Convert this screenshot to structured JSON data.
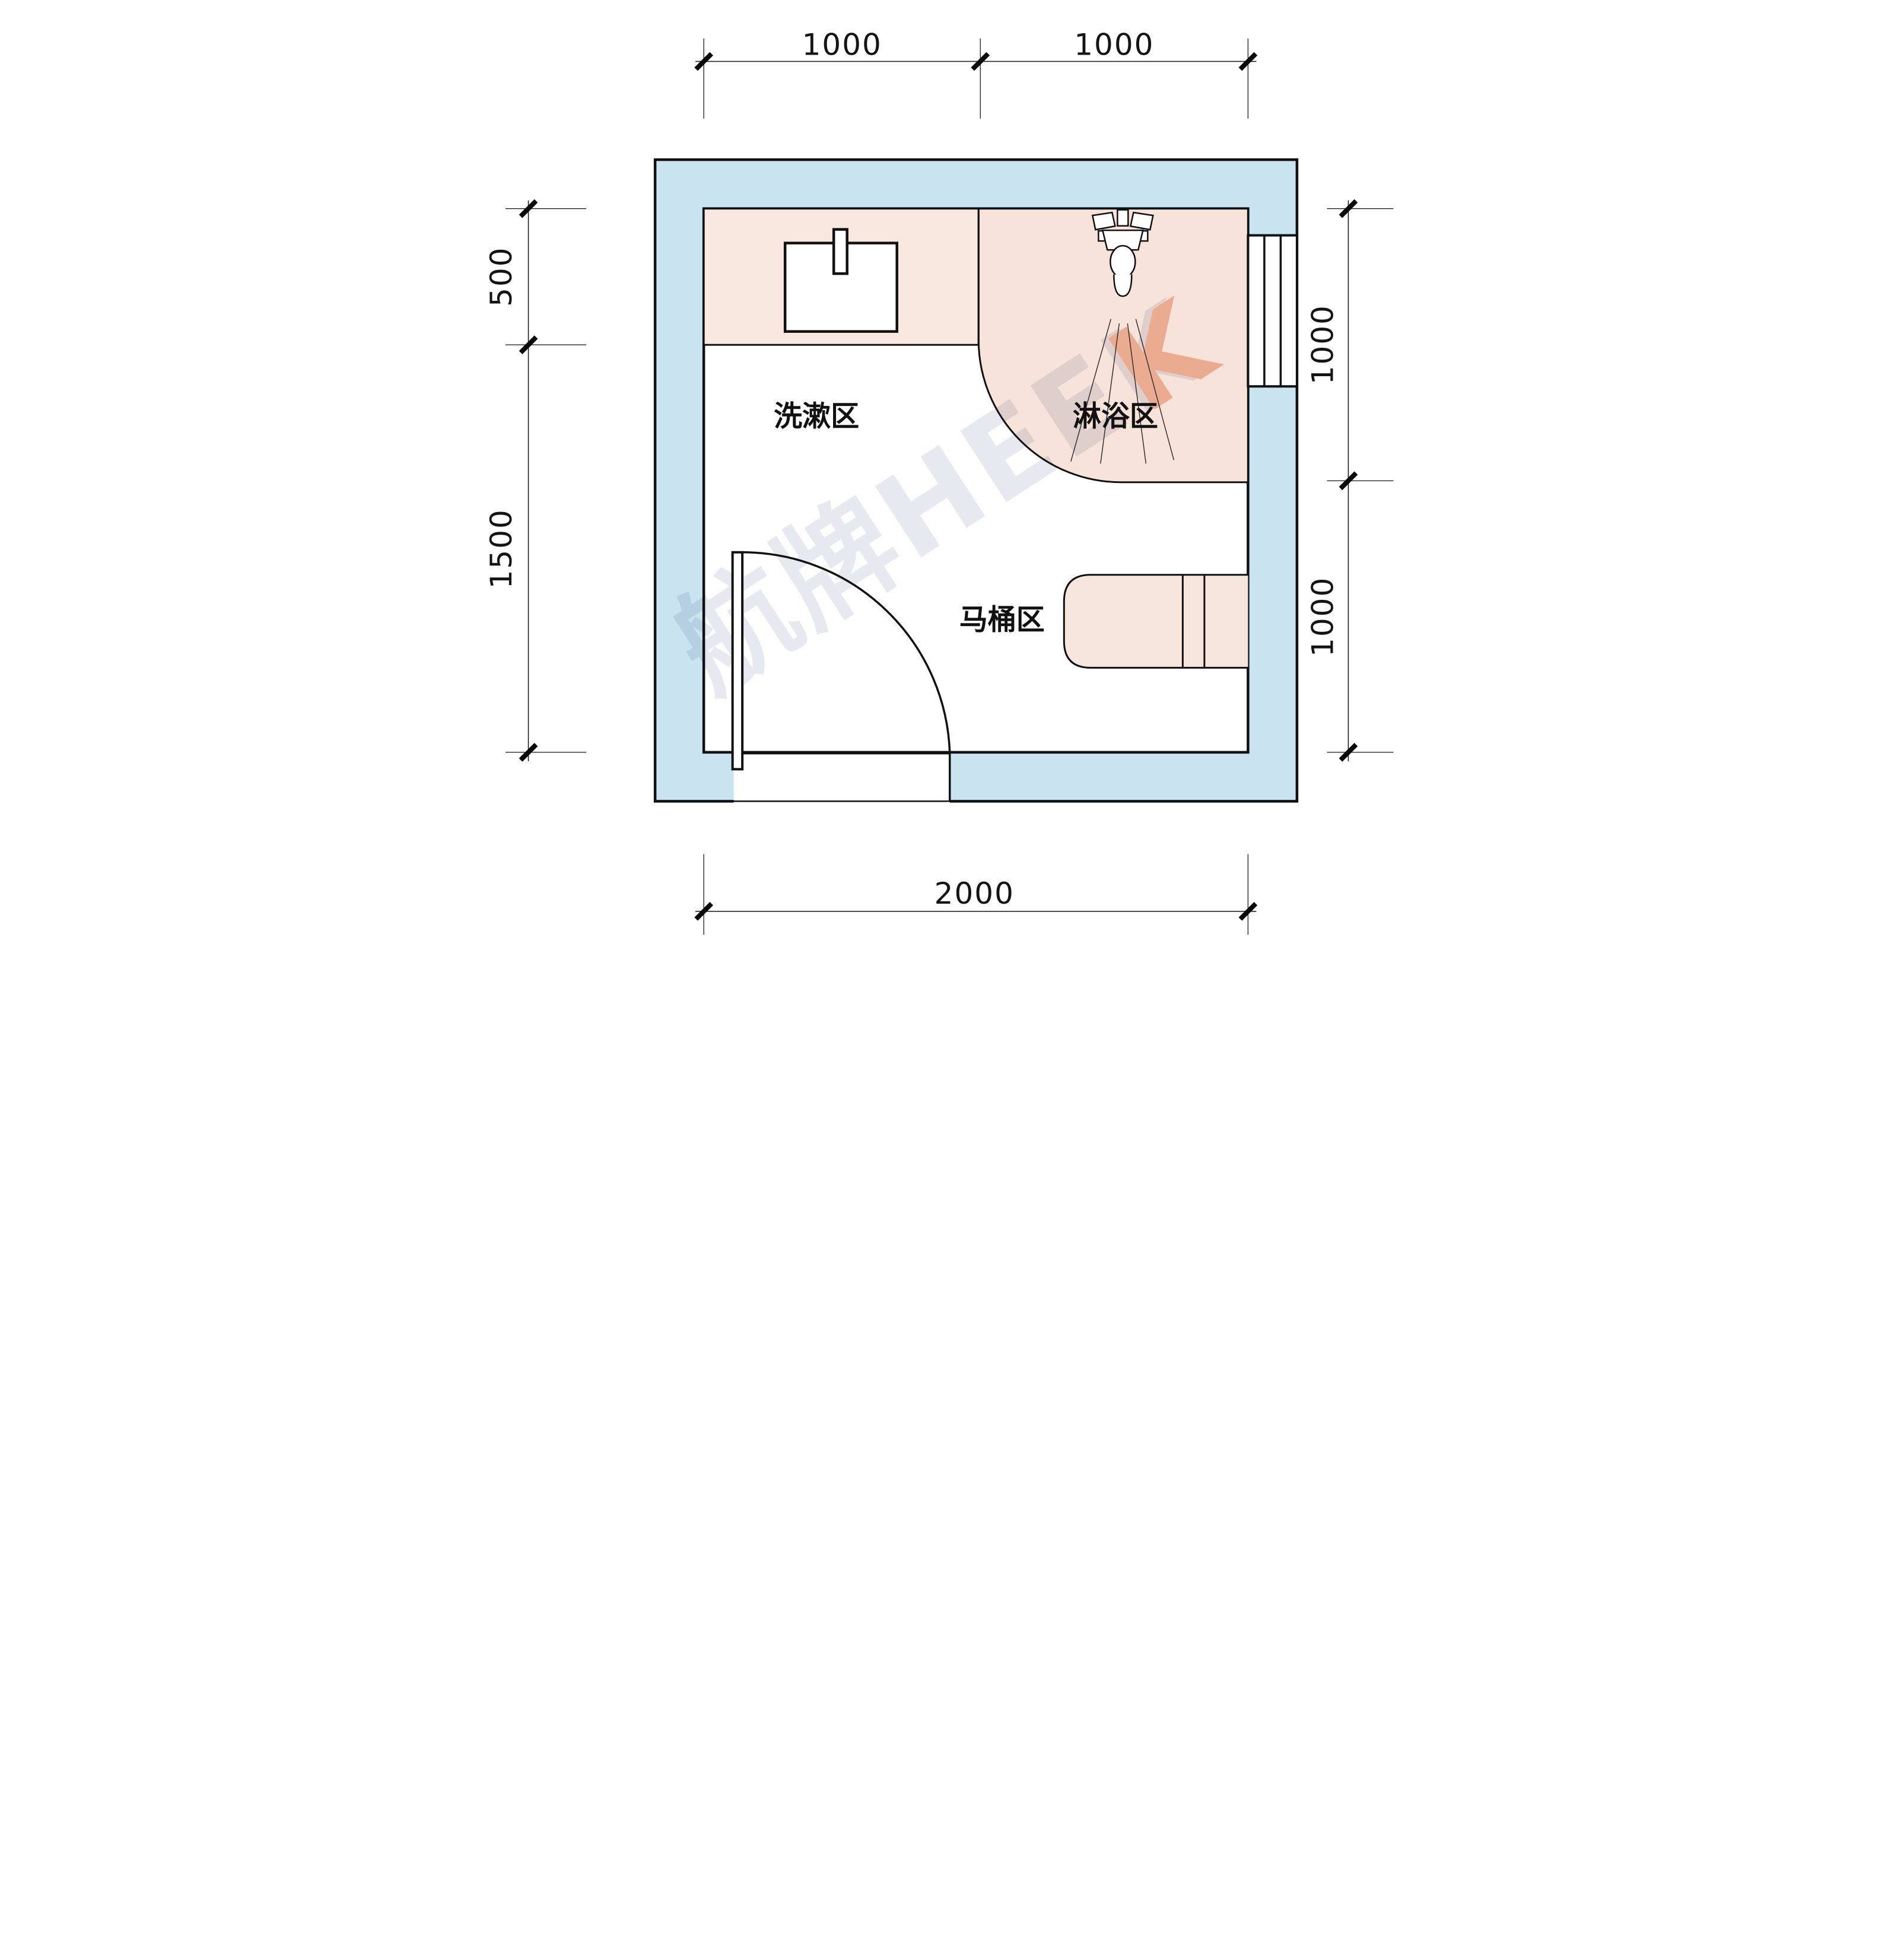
{
  "title": "bathroom-floor-plan",
  "labels": {
    "washing_area": "洗漱区",
    "shower_area": "淋浴区",
    "toilet_area": "马桶区"
  },
  "watermark": {
    "full": "航牌HEEK",
    "brand_cn": "航牌",
    "brand_en": "HEEK",
    "accent_letter": "K"
  },
  "dimensions": {
    "top": [
      "1000",
      "1000"
    ],
    "left": [
      "500",
      "1500"
    ],
    "right": [
      "1000",
      "1000"
    ],
    "bottom": [
      "2000"
    ]
  },
  "colors": {
    "wall_fill": "#cae3f0",
    "zone_fill_sink": "#f8e8e0",
    "zone_fill_shower": "#f7e3da",
    "zone_fill_toilet": "#f7e6de",
    "line": "#111111",
    "watermark_gray": "#e6e9f0",
    "watermark_accent": "#f3c0aa",
    "dim_color": "#141414"
  }
}
